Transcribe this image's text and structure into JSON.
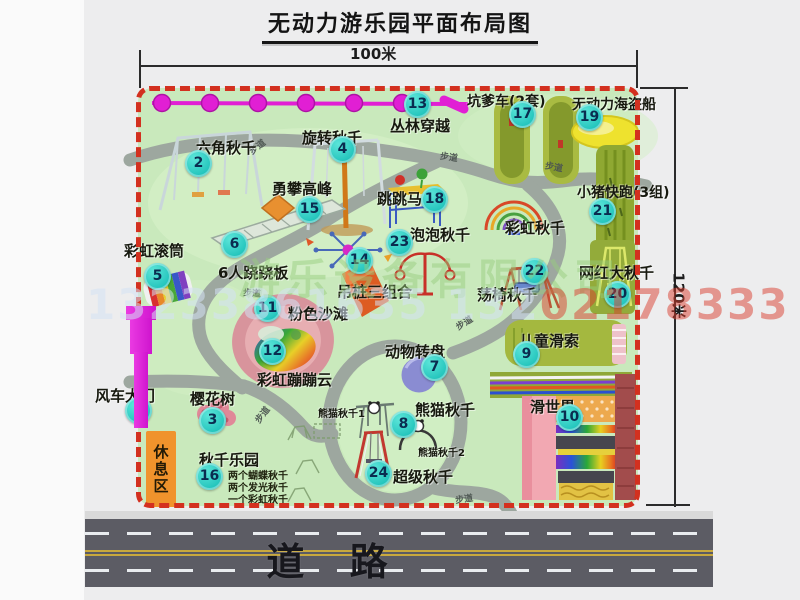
{
  "title": "无动力游乐园平面布局图",
  "dimensions": {
    "width": "100米",
    "height": "120米"
  },
  "road": {
    "label": "道 路"
  },
  "watermark": {
    "company": "游乐设备有限公司",
    "phone_left": "13233861635 132",
    "phone_right": "02178333"
  },
  "path_label": "步道",
  "rest_area": {
    "label": "休息区"
  },
  "extra_labels": {
    "rainbow_swing": "彩虹秋千"
  },
  "notes": {
    "panda1": "熊猫秋千1",
    "panda2": "熊猫秋千2",
    "swing_park": [
      "两个蝴蝶秋千",
      "两个发光秋千",
      "一个彩虹秋千"
    ]
  },
  "attractions": [
    {
      "num": "1",
      "label": "风车大门"
    },
    {
      "num": "2",
      "label": "六角秋千"
    },
    {
      "num": "3",
      "label": "樱花树"
    },
    {
      "num": "4",
      "label": "旋转秋千"
    },
    {
      "num": "5",
      "label": "彩虹滚筒"
    },
    {
      "num": "6",
      "label": "6人跷跷板"
    },
    {
      "num": "7",
      "label": "动物转盘"
    },
    {
      "num": "8",
      "label": "熊猫秋千"
    },
    {
      "num": "9",
      "label": "儿童滑索"
    },
    {
      "num": "10",
      "label": "滑世界"
    },
    {
      "num": "11",
      "label": "粉色沙滩"
    },
    {
      "num": "12",
      "label": "彩虹蹦蹦云"
    },
    {
      "num": "13",
      "label": "丛林穿越"
    },
    {
      "num": "14",
      "label": "吊桩三组合"
    },
    {
      "num": "15",
      "label": "勇攀高峰"
    },
    {
      "num": "16",
      "label": "秋千乐园"
    },
    {
      "num": "17",
      "label": "坑爹车(2套)"
    },
    {
      "num": "18",
      "label": "跳跳马"
    },
    {
      "num": "19",
      "label": "无动力海盗船"
    },
    {
      "num": "20",
      "label": "网红大秋千"
    },
    {
      "num": "21",
      "label": "小猪快跑(3组)"
    },
    {
      "num": "22",
      "label": "荡椅秋千"
    },
    {
      "num": "23",
      "label": "泡泡秋千"
    },
    {
      "num": "24",
      "label": "超级秋千"
    }
  ],
  "colors": {
    "map_green": "#c9e9bc",
    "border_red": "#d3301f",
    "badge_teal": "#1fc2ba",
    "zipline_magenta": "#e11fd4",
    "rest_orange": "#f0932c",
    "road_gray": "#5c5c64"
  }
}
